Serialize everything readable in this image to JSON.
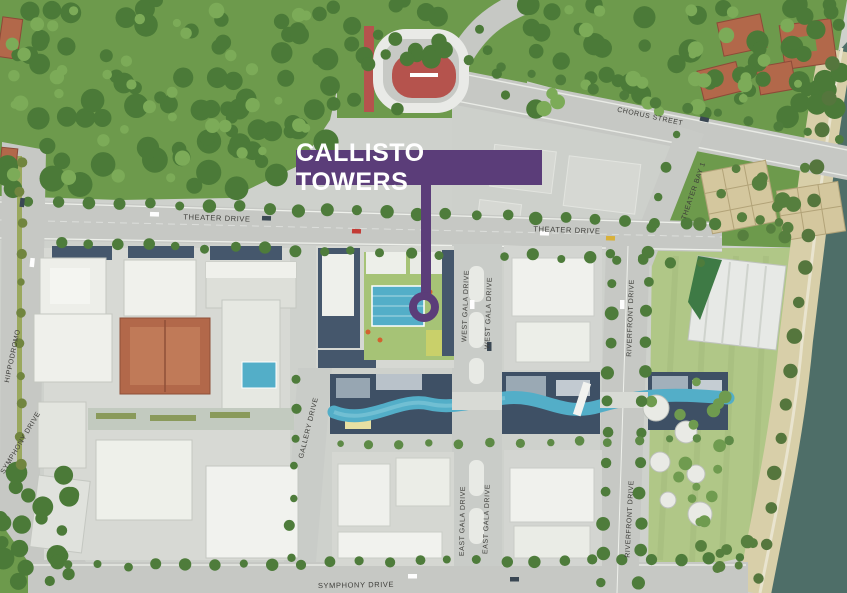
{
  "banner": {
    "label": "CALLISTO TOWERS"
  },
  "streets": {
    "chorus": "CHORUS STREET",
    "theater_w": "THEATER DRIVE",
    "theater_e": "THEATER DRIVE",
    "theater_bay": "THEATER BAY 1",
    "hippodromo": "HIPPODROMO",
    "west_gala_1": "WEST GALA DRIVE",
    "west_gala_2": "WEST GALA DRIVE",
    "riverfront_n": "RIVERFRONT DRIVE",
    "riverfront_s": "RIVERFRONT DRIVE",
    "gallery": "GALLERY DRIVE",
    "east_gala_1": "EAST GALA DRIVE",
    "east_gala_2": "EAST GALA DRIVE",
    "symphony_s": "SYMPHONY DRIVE",
    "symphony_w": "SYMPHONY DRIVE"
  },
  "colors": {
    "banner_purple": "#5b3d79",
    "water_teal": "#4e6e68",
    "canal_blue": "#53aec8",
    "road_gray": "#c6c8c4",
    "lawn_green": "#b0c787",
    "forest_green": "#6d9a4c",
    "roof_terracotta": "#b2684a",
    "track_red": "#b5534d",
    "promenade_sand": "#d8cfa9"
  }
}
